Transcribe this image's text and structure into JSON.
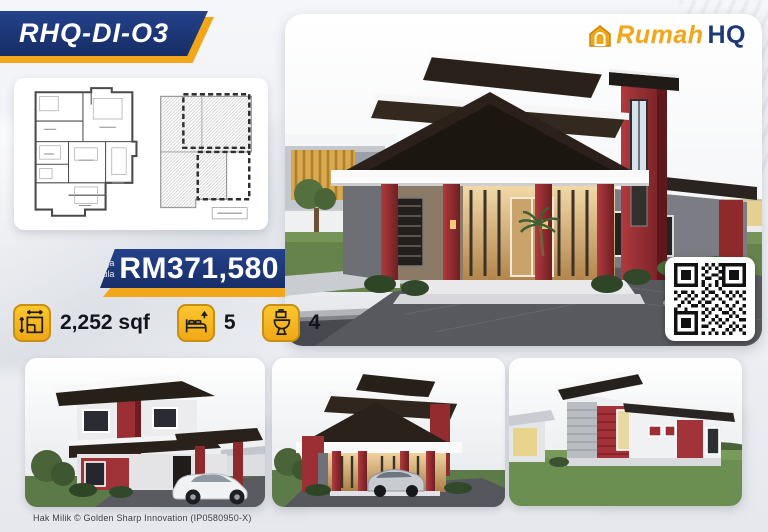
{
  "title_banner": {
    "label": "RHQ-DI-O3"
  },
  "brand": {
    "word1": "Rumah",
    "word2": "HQ",
    "icon": "house-logo-icon"
  },
  "price_banner": {
    "prefix_line1": "Harga",
    "prefix_line2": "bermula",
    "amount": "RM371,580"
  },
  "stats": {
    "area": {
      "icon": "floor-area-icon",
      "value": "2,252 sqf"
    },
    "bedrooms": {
      "icon": "bed-icon",
      "value": "5"
    },
    "bathrooms": {
      "icon": "toilet-icon",
      "value": "4"
    }
  },
  "qr": {
    "icon": "qr-code"
  },
  "footer": {
    "copyright": "Hak Milik © Golden Sharp Innovation (IP0580950-X)"
  },
  "colors": {
    "navy": "#1c3876",
    "gold": "#f2a71b",
    "maroon": "#8e2b2d",
    "roof_dark": "#29211b"
  }
}
